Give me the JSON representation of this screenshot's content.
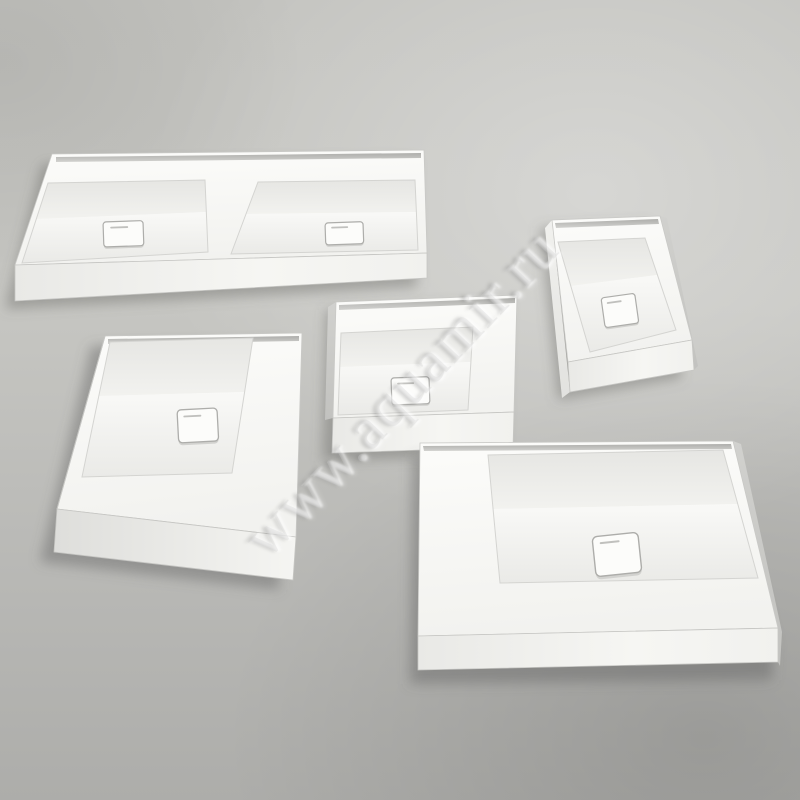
{
  "photo": {
    "description": "Studio product photograph of five white rectangular solid-surface countertop washbasins arranged on a seamless gray background, viewed from above at an angle",
    "watermark": {
      "text": "www.aquamir.ru"
    },
    "colors": {
      "bg_light": "#c3c3bf",
      "bg_mid": "#c6c6c2",
      "bg_dark": "#adadaa",
      "porcelain": "#f7f7f4",
      "porcelain_bright": "#fcfcfa",
      "bowl_shade": "#e9e9e6",
      "side_shade": "#c9c9c6",
      "back_channel": "#a5a5a2",
      "cast_shadow": "#5f5f5d",
      "drain_outline": "#adadaa",
      "watermark_fill": "#d2d2cf"
    },
    "objects": [
      {
        "id": "basin-double",
        "label": "wide double washbasin with two bowls and two square drain covers",
        "bowls": 2,
        "drains": 2
      },
      {
        "id": "basin-small",
        "label": "small rectangular washbasin with square drain cover",
        "bowls": 1,
        "drains": 1
      },
      {
        "id": "basin-square",
        "label": "square washbasin with offset corner bowl and square drain cover",
        "bowls": 1,
        "drains": 1
      },
      {
        "id": "basin-medium",
        "label": "medium rectangular washbasin with L-shaped deck and square drain cover",
        "bowls": 1,
        "drains": 1
      },
      {
        "id": "basin-large",
        "label": "large rectangular washbasin with L-shaped deck and square drain cover",
        "bowls": 1,
        "drains": 1
      }
    ]
  }
}
